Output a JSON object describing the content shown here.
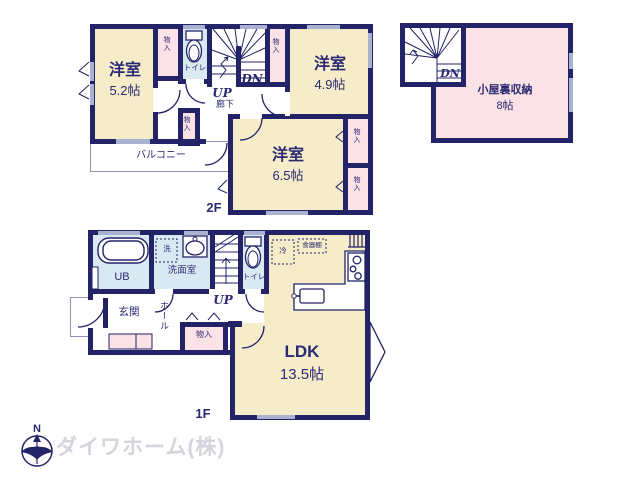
{
  "plan": {
    "floor2": {
      "floor_label": "2F",
      "rooms": {
        "bedroom_w": {
          "label": "洋室",
          "size": "5.2帖"
        },
        "bedroom_e": {
          "label": "洋室",
          "size": "4.9帖"
        },
        "bedroom_s": {
          "label": "洋室",
          "size": "6.5帖"
        },
        "toilet": {
          "label": "トイレ"
        },
        "hallway": {
          "label": "廊下"
        },
        "balcony": {
          "label": "バルコニー"
        },
        "closet": {
          "label": "物入"
        },
        "stairs_up": {
          "label": "UP"
        },
        "stairs_dn": {
          "label": "DN"
        }
      }
    },
    "attic": {
      "rooms": {
        "storage": {
          "label": "小屋裏収納",
          "size": "8帖"
        },
        "stairs_dn": {
          "label": "DN"
        }
      }
    },
    "floor1": {
      "floor_label": "1F",
      "rooms": {
        "ldk": {
          "label": "LDK",
          "size": "13.5帖"
        },
        "bath": {
          "label": "UB"
        },
        "washroom": {
          "label": "洗面室"
        },
        "washer": {
          "label": "洗"
        },
        "toilet": {
          "label": "トイレ"
        },
        "entrance": {
          "label": "玄関"
        },
        "hall": {
          "label": "ホール"
        },
        "closet": {
          "label": "物入"
        },
        "fridge": {
          "label": "冷"
        },
        "cupboard": {
          "label": "食器棚"
        },
        "stairs_up": {
          "label": "UP"
        }
      }
    }
  },
  "footer": {
    "company": "ダイワホーム(株)",
    "compass_north": "N"
  },
  "colors": {
    "wall": "#232368",
    "room_cream": "#f6ecca",
    "room_pink": "#fbe2e6",
    "room_blue": "#d9e9f2",
    "window_mark": "#aab2d2",
    "logo_gray": "#d4d4dc"
  }
}
